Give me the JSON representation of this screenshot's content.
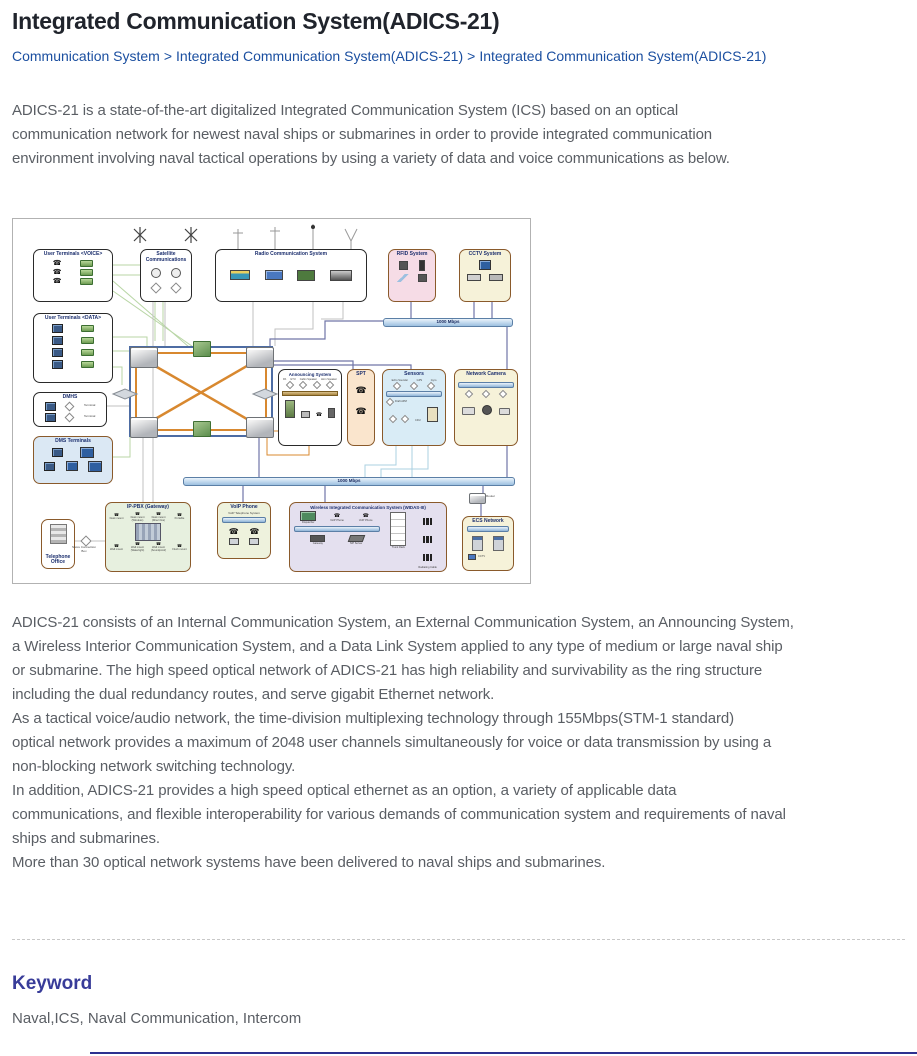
{
  "page": {
    "title": "Integrated Communication System(ADICS-21)",
    "breadcrumb": {
      "separator": ">",
      "items": [
        "Communication System",
        "Integrated Communication System(ADICS-21)",
        "Integrated Communication System(ADICS-21)"
      ]
    },
    "intro_lines": [
      "ADICS-21 is a state-of-the-art digitalized Integrated Communication System (ICS) based on an optical",
      "communication network for newest naval ships or submarines in order to provide integrated communication",
      "environment involving naval tactical operations by using a variety of data and voice communications as below."
    ],
    "body_lines": [
      "ADICS-21 consists of an Internal Communication System, an External Communication System, an Announcing System,",
      "a Wireless Interior Communication System, and a Data Link System applied to any type of medium or large naval ship",
      "or submarine. The high speed optical network of ADICS-21 has high reliability and survivability as the ring structure",
      "including the dual redundancy routes, and serve gigabit Ethernet network.",
      "As a tactical voice/audio network, the time-division multiplexing technology through 155Mbps(STM-1 standard)",
      "optical network provides a maximum of 2048 user channels simultaneously for voice or data transmission by using a",
      "non-blocking network switching technology.",
      "In addition, ADICS-21 provides a high speed optical ethernet as an option, a variety of applicable data",
      "communications, and flexible interoperability for various demands of communication system and requirements of naval",
      "ships and submarines.",
      "More than 30 optical network systems have been delivered to naval ships and submarines."
    ],
    "keyword": {
      "heading": "Keyword",
      "text": "Naval,ICS, Naval Communication, Intercom"
    }
  },
  "diagram": {
    "boxes": {
      "user_voice": "User Terminals <VOICE>",
      "user_data": "User Terminals <DATA>",
      "dmhs": "DMHS",
      "dms_terminals": "DMS Terminals",
      "satellite": "Satellite Communications",
      "radio": "Radio Communication System",
      "rfid": "RFID System",
      "cctv": "CCTV System",
      "announcing": "Announcing System",
      "spt": "SPT",
      "sensors": "Sensors",
      "network_camera": "Network Camera",
      "telephone_office": "Telephone Office",
      "ip_pbx": "IP-PBX (Gateway)",
      "voip": "VoIP Phone",
      "widas": "Wireless Integrated Communication System (WIDAS-III)",
      "ecs": "ECS Network"
    },
    "labels": {
      "bus": "1000 Mbps",
      "router": "Router",
      "terminal": "Terminal",
      "voip_system": "VoIP Telephone System",
      "cctv_small": "CCTV",
      "shore_box": "Shore Connection Box"
    },
    "announcing_items": [
      "PA",
      "GTU",
      "Cabin Speaker",
      "Horn Speaker"
    ],
    "sensors_items": [
      "Echo Sounder",
      "GPS",
      "Gyro",
      "Draft APM",
      "CDU"
    ],
    "widas_items": [
      "Dispatcher",
      "VoIP Phone",
      "VoIP Phone",
      "Gateway",
      "SIP Server",
      "Trunk Rack",
      "Radiating Cable"
    ],
    "pbx_items": [
      "Desk mount",
      "Desk mount (Wireless)",
      "Desk mount (Direct line)",
      "Portable",
      "Wall mount",
      "Wall mount (Watertight)",
      "Wall mount (Soundproof)",
      "Flush mount"
    ]
  },
  "colors": {
    "breadcrumb_link": "#1b4fa0",
    "title_text": "#20242c",
    "body_text": "#5a5e64",
    "keyword_heading": "#383c99",
    "bottom_rule": "#2d3190",
    "ring_blue": "#4d6ca3",
    "ring_orange": "#d8882f",
    "bus_fill": "#9cc0e0"
  }
}
